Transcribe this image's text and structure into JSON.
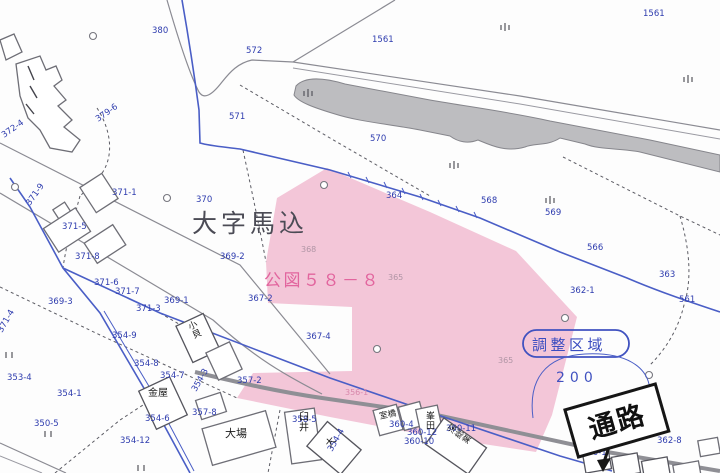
{
  "map": {
    "region_title": "大字馬込",
    "koizu_label": "公図５８－８",
    "stamp_label": "調整区域",
    "area_label": "200",
    "passage_label": "通路",
    "colors": {
      "highlight_pink": "#f3c6d8",
      "pink_text": "#e2659e",
      "parcel_label_blue": "#2e3cae",
      "boundary_blue": "#4a5ec6",
      "stamp_blue": "#3a4cc0",
      "map_line_gray": "#8b8b93",
      "water_gray": "#bdbdc0",
      "road_dark": "#8f8f95",
      "ink": "#1b1b1b"
    },
    "labels": [
      {
        "text": "380",
        "x": 152,
        "y": 33
      },
      {
        "text": "1561",
        "x": 372,
        "y": 42
      },
      {
        "text": "1561",
        "x": 643,
        "y": 16
      },
      {
        "text": "572",
        "x": 246,
        "y": 53
      },
      {
        "text": "571",
        "x": 229,
        "y": 119
      },
      {
        "text": "570",
        "x": 370,
        "y": 141
      },
      {
        "text": "364",
        "x": 386,
        "y": 198
      },
      {
        "text": "568",
        "x": 481,
        "y": 203
      },
      {
        "text": "569",
        "x": 545,
        "y": 215
      },
      {
        "text": "566",
        "x": 587,
        "y": 250
      },
      {
        "text": "363",
        "x": 659,
        "y": 277
      },
      {
        "text": "561",
        "x": 679,
        "y": 302
      },
      {
        "text": "362-1",
        "x": 570,
        "y": 293
      },
      {
        "text": "362-8",
        "x": 657,
        "y": 443
      },
      {
        "text": "370",
        "x": 196,
        "y": 202
      },
      {
        "text": "369-2",
        "x": 220,
        "y": 259
      },
      {
        "text": "367-2",
        "x": 248,
        "y": 301
      },
      {
        "text": "367-4",
        "x": 306,
        "y": 339
      },
      {
        "text": "369-1",
        "x": 164,
        "y": 303
      },
      {
        "text": "369-3",
        "x": 48,
        "y": 304
      },
      {
        "text": "371-1",
        "x": 112,
        "y": 195
      },
      {
        "text": "371-5",
        "x": 62,
        "y": 229
      },
      {
        "text": "371-8",
        "x": 75,
        "y": 259
      },
      {
        "text": "371-6",
        "x": 94,
        "y": 285
      },
      {
        "text": "371-7",
        "x": 115,
        "y": 294
      },
      {
        "text": "371-3",
        "x": 136,
        "y": 311
      },
      {
        "text": "371-9",
        "x": 30,
        "y": 206,
        "rot": -55
      },
      {
        "text": "379-6",
        "x": 98,
        "y": 122,
        "rot": -35
      },
      {
        "text": "372-4",
        "x": 4,
        "y": 138,
        "rot": -35
      },
      {
        "text": "371-4",
        "x": 2,
        "y": 333,
        "rot": -60
      },
      {
        "text": "353-4",
        "x": 7,
        "y": 380
      },
      {
        "text": "354-1",
        "x": 57,
        "y": 396
      },
      {
        "text": "350-5",
        "x": 34,
        "y": 426
      },
      {
        "text": "354-9",
        "x": 112,
        "y": 338
      },
      {
        "text": "354-8",
        "x": 134,
        "y": 366
      },
      {
        "text": "354-7",
        "x": 160,
        "y": 378
      },
      {
        "text": "354-6",
        "x": 145,
        "y": 421
      },
      {
        "text": "354-12",
        "x": 120,
        "y": 443
      },
      {
        "text": "354-3",
        "x": 196,
        "y": 392,
        "rot": -60
      },
      {
        "text": "354-4",
        "x": 332,
        "y": 452,
        "rot": -60
      },
      {
        "text": "357-8",
        "x": 192,
        "y": 415
      },
      {
        "text": "357-2",
        "x": 237,
        "y": 383
      },
      {
        "text": "358-5",
        "x": 292,
        "y": 422
      },
      {
        "text": "360-4",
        "x": 389,
        "y": 427
      },
      {
        "text": "360-12",
        "x": 407,
        "y": 435
      },
      {
        "text": "360-10",
        "x": 404,
        "y": 444
      },
      {
        "text": "360-11",
        "x": 446,
        "y": 431
      },
      {
        "text": "360-1",
        "x": 582,
        "y": 455
      },
      {
        "text": "368",
        "x": 301,
        "y": 252,
        "cls": "lb-faint"
      },
      {
        "text": "365",
        "x": 388,
        "y": 280,
        "cls": "lb-faint"
      },
      {
        "text": "365",
        "x": 498,
        "y": 363,
        "cls": "lb-faint"
      },
      {
        "text": "356-1",
        "x": 345,
        "y": 395,
        "cls": "lb-pink"
      },
      {
        "text": "金屋",
        "x": 148,
        "y": 396,
        "cls": "lb-name",
        "size": 10,
        "name": "building-label"
      },
      {
        "text": "大場",
        "x": 225,
        "y": 437,
        "cls": "lb-name",
        "size": 11,
        "name": "building-label"
      },
      {
        "text": "臼井",
        "x": 299,
        "y": 420,
        "cls": "lb-name",
        "size": 10,
        "vertical": true,
        "name": "building-label"
      },
      {
        "text": "室橋",
        "x": 380,
        "y": 419,
        "cls": "lb-name",
        "size": 8.5,
        "rot": -12,
        "name": "building-label"
      },
      {
        "text": "峯田",
        "x": 426,
        "y": 419,
        "cls": "lb-name",
        "size": 9,
        "vertical": true,
        "name": "building-label"
      },
      {
        "text": "大",
        "x": 330,
        "y": 448,
        "cls": "lb-name",
        "size": 10,
        "rot": -50,
        "name": "building-label"
      },
      {
        "text": "深総業",
        "x": 452,
        "y": 434,
        "cls": "lb-name",
        "size": 8.5,
        "vertical": true,
        "rot": -55,
        "name": "building-label"
      },
      {
        "text": "小貝",
        "x": 190,
        "y": 330,
        "cls": "lb-name",
        "size": 9,
        "vertical": true,
        "rot": -25,
        "name": "building-label"
      }
    ],
    "rice_field_symbols": [
      [
        304,
        88
      ],
      [
        450,
        160
      ],
      [
        546,
        195
      ],
      [
        501,
        22
      ],
      [
        684,
        74
      ]
    ],
    "field_tick_symbols": [
      [
        6,
        352
      ],
      [
        45,
        431
      ],
      [
        138,
        465
      ]
    ],
    "survey_circles": [
      [
        93,
        36
      ],
      [
        15,
        187
      ],
      [
        167,
        198
      ],
      [
        324,
        185
      ],
      [
        377,
        349
      ],
      [
        565,
        318
      ],
      [
        649,
        375
      ]
    ]
  }
}
